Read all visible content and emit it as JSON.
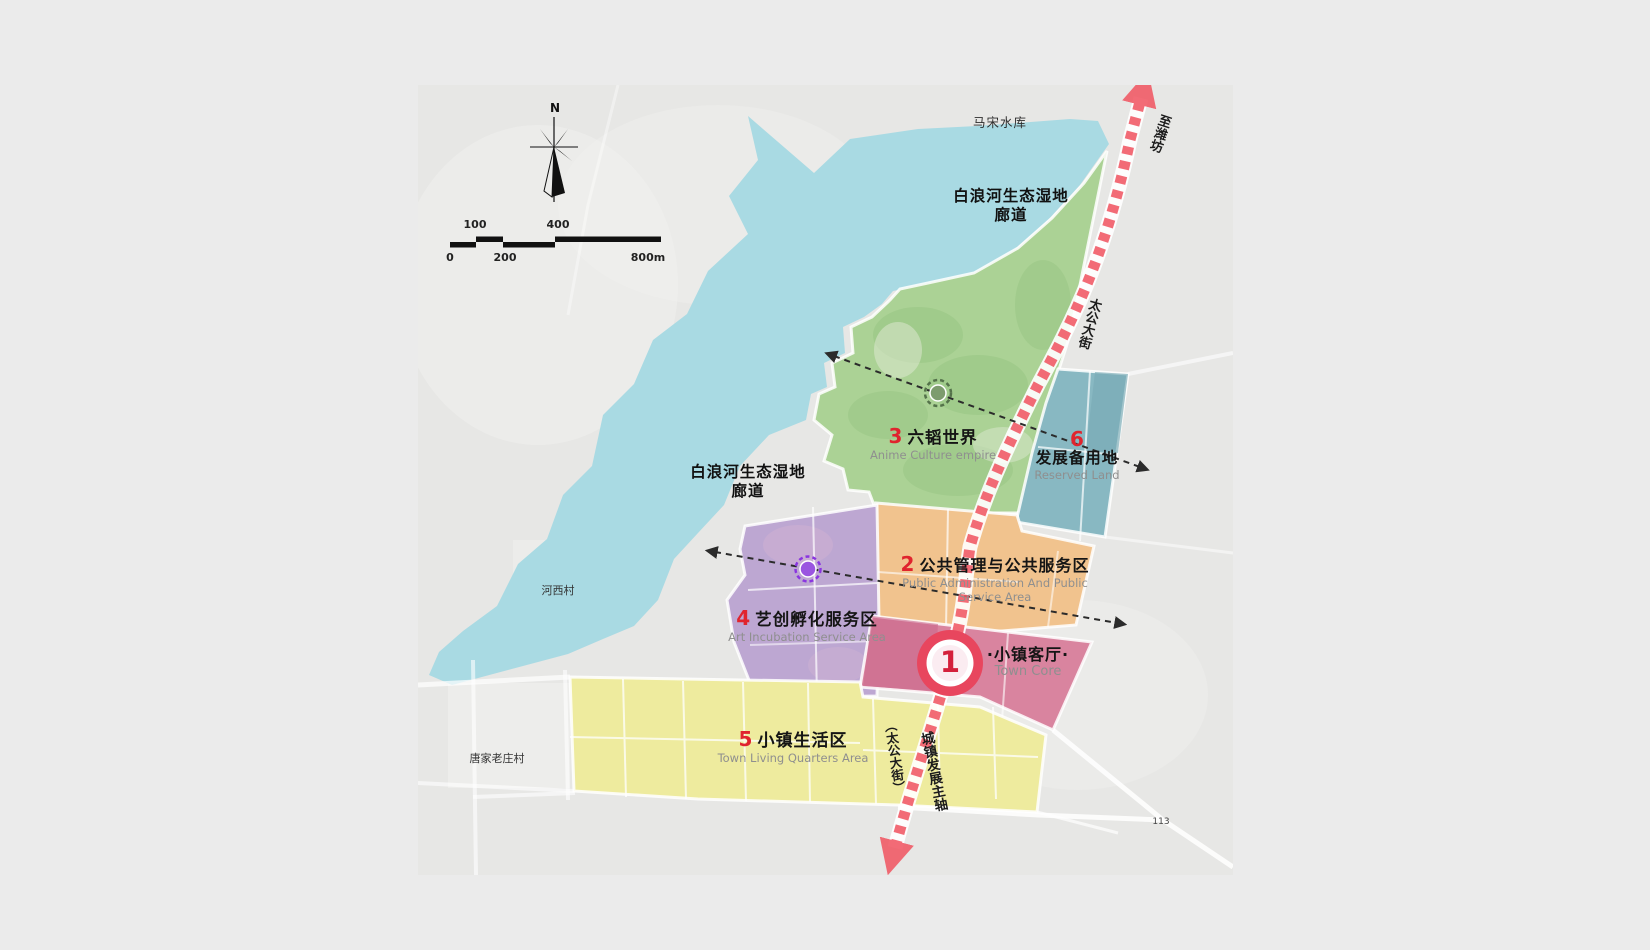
{
  "map": {
    "compass_n": "N",
    "scalebar": {
      "l100": "100",
      "l400": "400",
      "l0": "0",
      "l200": "200",
      "l800": "800m"
    },
    "context": {
      "reservoir": "马宋水库",
      "wetland_top_1": "白浪河生态湿地",
      "wetland_top_2": "廊道",
      "wetland_left_1": "白浪河生态湿地",
      "wetland_left_2": "廊道",
      "village_hexi": "河西村",
      "village_tangjia": "唐家老庄村",
      "road_113": "113",
      "to_weifang": "至潍坊",
      "taigong_street": "太公大街",
      "taigong_paren": "（太公大街）",
      "dev_axis": "城镇发展主轴"
    },
    "zones": [
      {
        "num": "1",
        "cn": "·小镇客厅·",
        "en": "Town Core",
        "color": "#d9849f"
      },
      {
        "num": "2",
        "cn": "公共管理与公共服务区",
        "en": "Public Administration And Public Service Area",
        "color": "#f1c38e"
      },
      {
        "num": "3",
        "cn": "六韬世界",
        "en": "Anime Culture empire",
        "color": "#abd295"
      },
      {
        "num": "4",
        "cn": "艺创孵化服务区",
        "en": "Art Incubation Service Area",
        "color": "#bda7d2"
      },
      {
        "num": "5",
        "cn": "小镇生活区",
        "en": "Town Living Quarters Area",
        "color": "#eeeb9e"
      },
      {
        "num": "6",
        "cn": "发展备用地",
        "en": "Reserved Land",
        "color": "#88b8c2"
      }
    ],
    "colors": {
      "water": "#a9dae3",
      "axis_red": "#f15864",
      "number_red": "#e0242e",
      "en_gray": "#8f8f8f",
      "dash_black": "#2b2b2b"
    }
  }
}
